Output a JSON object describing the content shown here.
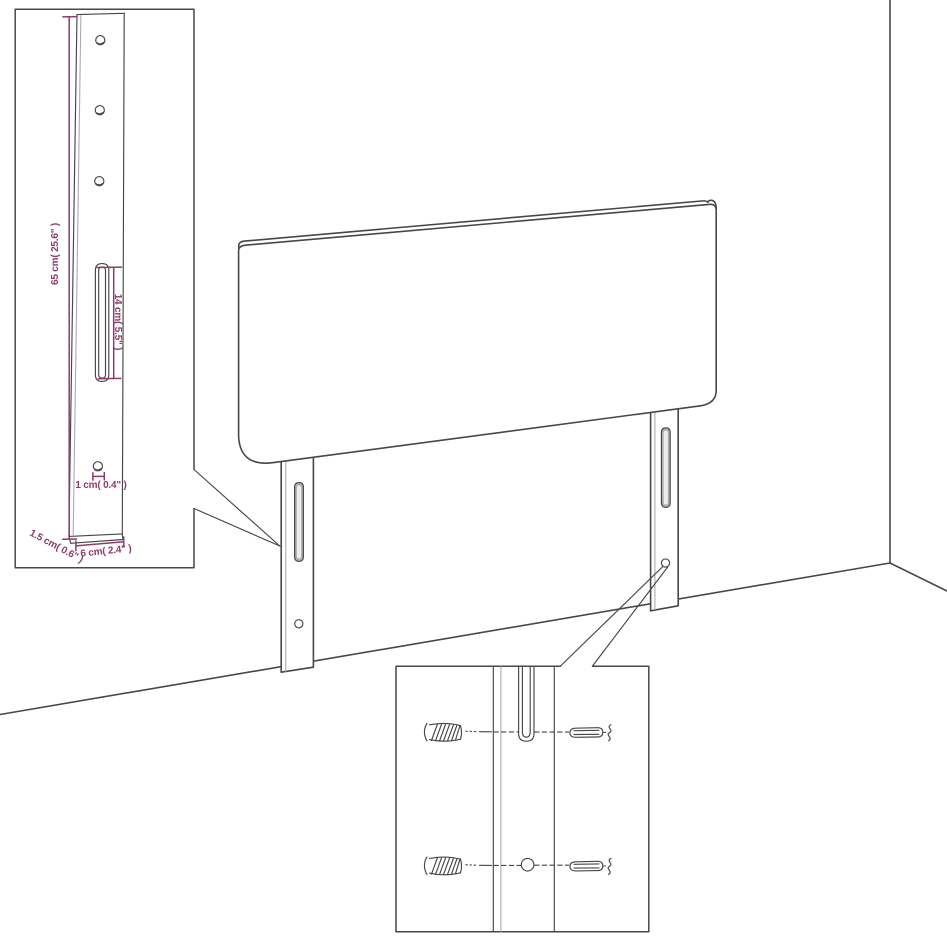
{
  "labels": {
    "height": "65 cm( 25.6\" )",
    "slot_length": "14 cm( 5.5\" )",
    "hole_diameter": "1 cm( 0.4\" )",
    "thickness": "1.5 cm( 0.6\" )",
    "width": "6 cm( 2.4\" )"
  },
  "colors": {
    "dimension": "#8E3A6E",
    "line": "#474747",
    "line_light": "#ABABAB",
    "slot_fill": "#ADADAD",
    "background": "#FFFFFF"
  }
}
